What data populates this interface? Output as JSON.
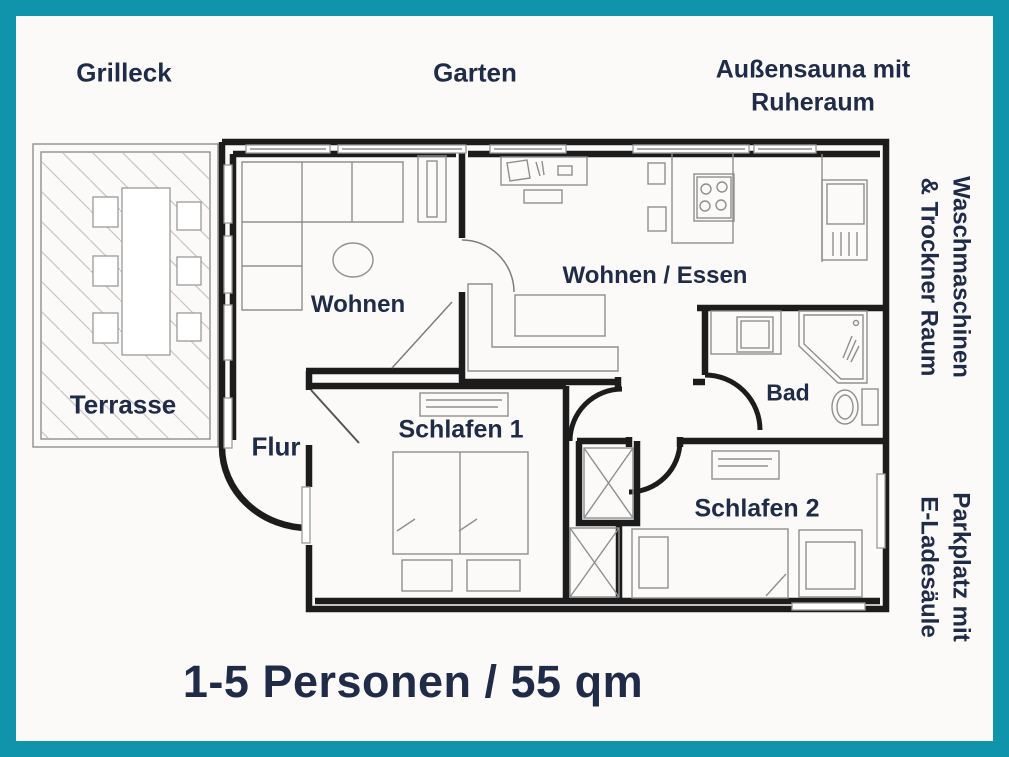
{
  "labels": {
    "grilleck": "Grilleck",
    "garten": "Garten",
    "sauna_line1": "Außensauna mit",
    "sauna_line2": "Ruheraum",
    "laundry_line1": "Waschmaschinen",
    "laundry_line2": "& Trockner Raum",
    "parking_line1": "Parkplatz mit",
    "parking_line2": "E-Ladesäule",
    "caption": "1-5 Personen / 55 qm"
  },
  "rooms": {
    "wohnen": "Wohnen",
    "wohnen_essen": "Wohnen / Essen",
    "bad": "Bad",
    "flur": "Flur",
    "schlafen1": "Schlafen 1",
    "schlafen2": "Schlafen 2",
    "terrasse": "Terrasse"
  },
  "apartment": {
    "occupancy": "1-5 Personen",
    "size": "55 qm"
  },
  "colors": {
    "frame-teal": "#1094ab",
    "ink": "#202c47",
    "paper": "#fbfaf8",
    "wall": "#1c1c1c",
    "furn": "#8f8f8f"
  }
}
